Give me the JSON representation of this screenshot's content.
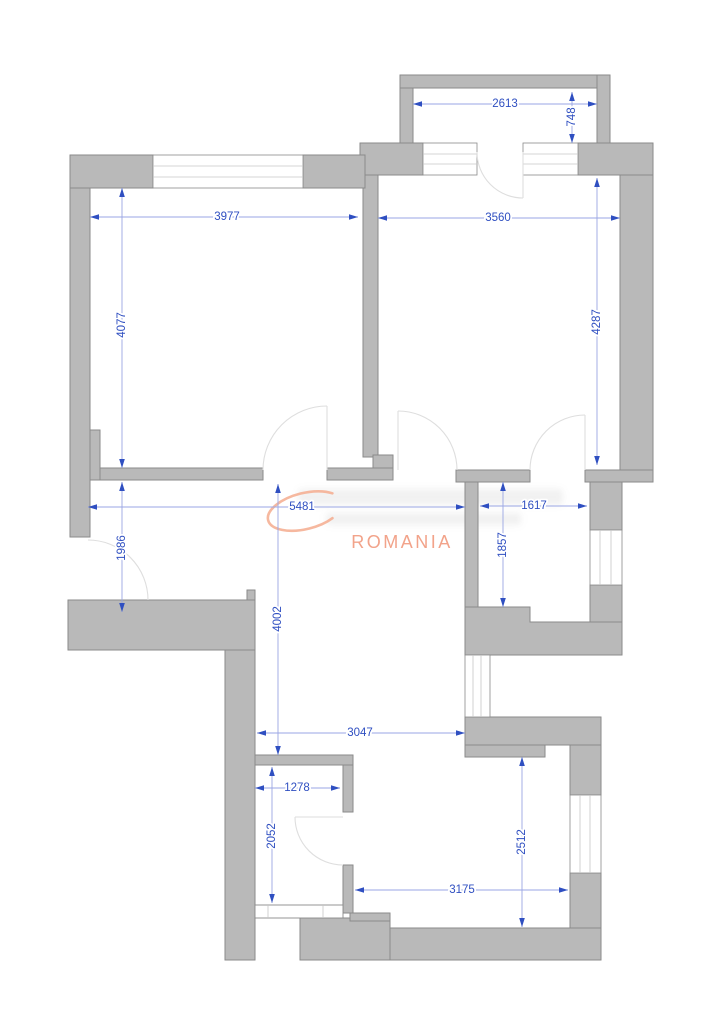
{
  "watermark": {
    "brand_text": "ROMANIA",
    "accent_color": "#f2a38a",
    "swoosh_color": "#f4ab8e"
  },
  "colors": {
    "wall_fill": "#b9b9b9",
    "wall_stroke": "#8a8a8a",
    "window_line": "#c6c6c6",
    "door_arc": "#dedede",
    "dim_line": "#9aa6e4",
    "dim_accent": "#2f4fc1"
  },
  "dimensions": [
    {
      "label": "2613",
      "x1": 413,
      "y1": 104,
      "x2": 597,
      "y2": 104,
      "lx": 505,
      "ly": 104,
      "vertical": false
    },
    {
      "label": "748",
      "x1": 572,
      "y1": 92,
      "x2": 572,
      "y2": 143,
      "lx": 572,
      "ly": 117,
      "vertical": true
    },
    {
      "label": "3977",
      "x1": 90,
      "y1": 217,
      "x2": 358,
      "y2": 217,
      "lx": 227,
      "ly": 217,
      "vertical": false
    },
    {
      "label": "3560",
      "x1": 378,
      "y1": 218,
      "x2": 620,
      "y2": 218,
      "lx": 498,
      "ly": 218,
      "vertical": false
    },
    {
      "label": "4077",
      "x1": 122,
      "y1": 188,
      "x2": 122,
      "y2": 468,
      "lx": 122,
      "ly": 325,
      "vertical": true
    },
    {
      "label": "4287",
      "x1": 597,
      "y1": 178,
      "x2": 597,
      "y2": 465,
      "lx": 597,
      "ly": 322,
      "vertical": true
    },
    {
      "label": "5481",
      "x1": 88,
      "y1": 507,
      "x2": 465,
      "y2": 507,
      "lx": 302,
      "ly": 507,
      "vertical": false
    },
    {
      "label": "1617",
      "x1": 480,
      "y1": 506,
      "x2": 587,
      "y2": 506,
      "lx": 534,
      "ly": 506,
      "vertical": false
    },
    {
      "label": "1986",
      "x1": 122,
      "y1": 482,
      "x2": 122,
      "y2": 612,
      "lx": 122,
      "ly": 548,
      "vertical": true
    },
    {
      "label": "1857",
      "x1": 503,
      "y1": 482,
      "x2": 503,
      "y2": 607,
      "lx": 503,
      "ly": 545,
      "vertical": true
    },
    {
      "label": "4002",
      "x1": 278,
      "y1": 484,
      "x2": 278,
      "y2": 755,
      "lx": 278,
      "ly": 619,
      "vertical": true
    },
    {
      "label": "3047",
      "x1": 257,
      "y1": 733,
      "x2": 465,
      "y2": 733,
      "lx": 360,
      "ly": 733,
      "vertical": false
    },
    {
      "label": "1278",
      "x1": 255,
      "y1": 788,
      "x2": 340,
      "y2": 788,
      "lx": 297,
      "ly": 788,
      "vertical": false
    },
    {
      "label": "2052",
      "x1": 272,
      "y1": 767,
      "x2": 272,
      "y2": 903,
      "lx": 272,
      "ly": 836,
      "vertical": true
    },
    {
      "label": "2512",
      "x1": 522,
      "y1": 757,
      "x2": 522,
      "y2": 927,
      "lx": 522,
      "ly": 842,
      "vertical": true
    },
    {
      "label": "3175",
      "x1": 355,
      "y1": 890,
      "x2": 568,
      "y2": 890,
      "lx": 462,
      "ly": 890,
      "vertical": false
    }
  ]
}
